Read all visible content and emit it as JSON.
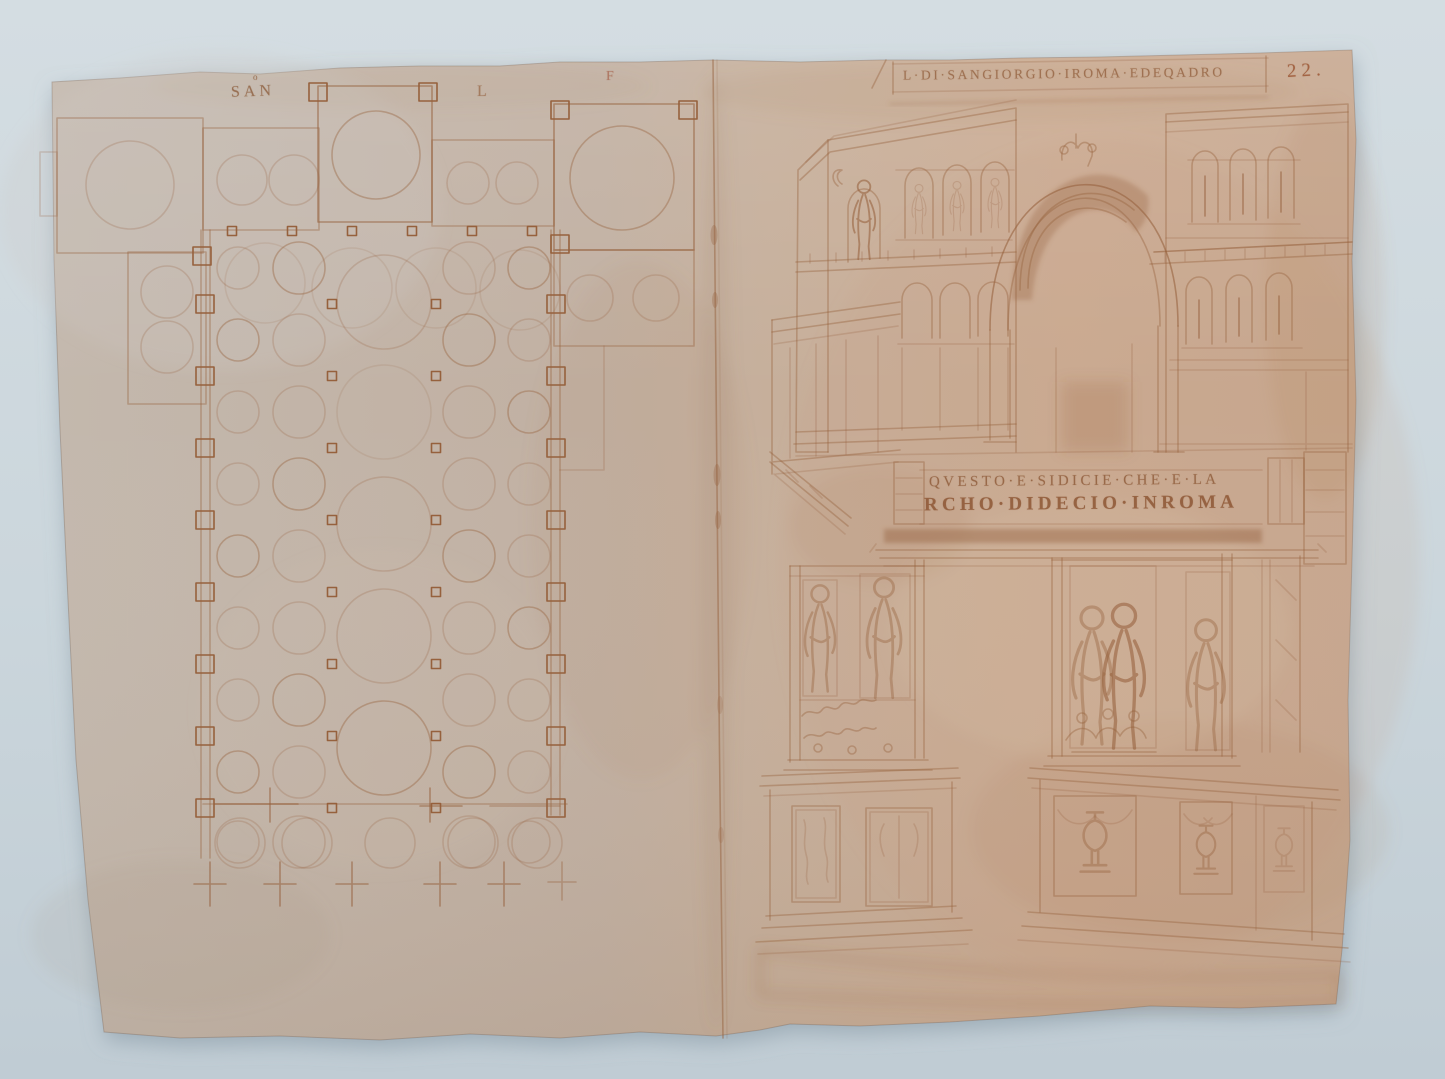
{
  "photo": {
    "background_color": "#cbd6dc",
    "paper_color_left": "#c3b8ad",
    "paper_color_right": "#c7a890",
    "ink_color": "#96613d"
  },
  "left_page": {
    "labels": {
      "san": "SAN",
      "san_mark": "o",
      "l": "L",
      "f": "F"
    }
  },
  "right_page": {
    "caption": "L·DI·SANGIORGIO·IROMA·EDEQADRO",
    "folio_number": "22.",
    "inscription_line1": "QVESTO·E·SIDICIE·CHE·E·LA",
    "inscription_line2": "RCHO·DIDECIO·INROMA"
  }
}
